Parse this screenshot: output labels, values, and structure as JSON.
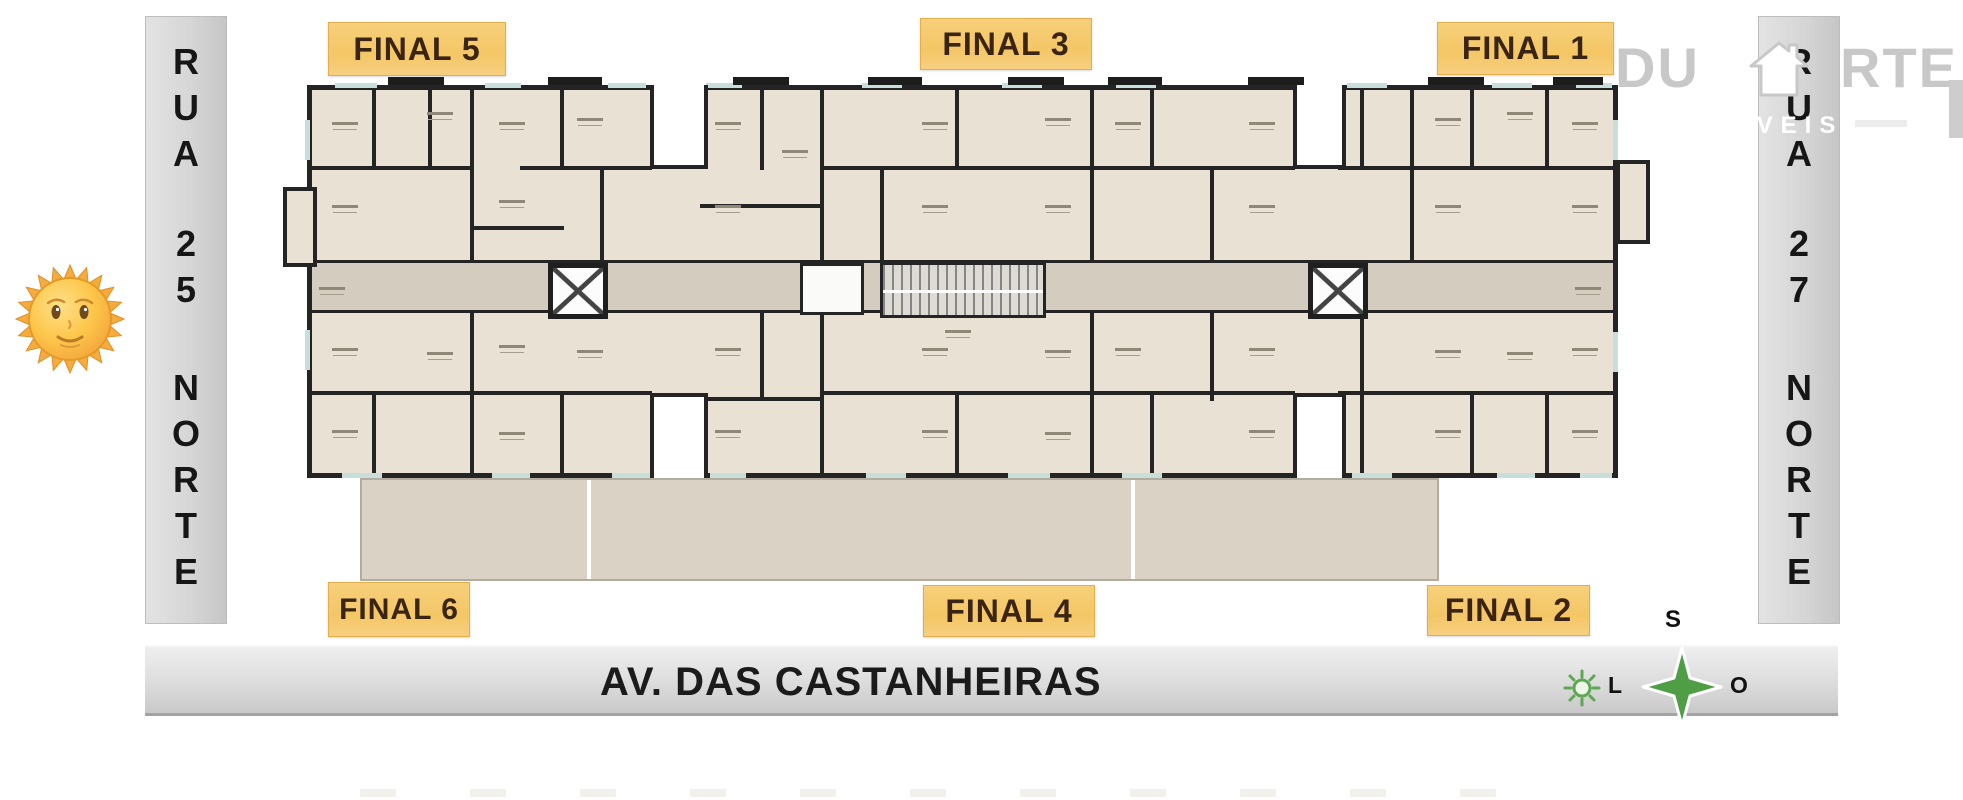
{
  "streets": {
    "rua_left": {
      "segments": [
        "RUA",
        "25",
        "NORTE"
      ]
    },
    "rua_right": {
      "segments": [
        "RUA",
        "27",
        "NORTE"
      ]
    },
    "avenue": {
      "name": "AV. DAS CASTANHEIRAS"
    }
  },
  "unit_labels": {
    "final_5": "FINAL 5",
    "final_3": "FINAL 3",
    "final_1": "FINAL 1",
    "final_6": "FINAL 6",
    "final_4": "FINAL 4",
    "final_2": "FINAL 2"
  },
  "compass": {
    "south": "S",
    "east": "L",
    "west": "O"
  },
  "watermark": {
    "name_prefix": "DU",
    "name_suffix": "RTE",
    "subtitle": "MÓVEIS"
  },
  "icons": {
    "sun_emoji": "sun-with-face",
    "compass_star": "four-point-star",
    "compass_sun": "sun-outline",
    "watermark_house": "house"
  },
  "colors": {
    "label_bg": "#f4c665",
    "label_text": "#3a2413",
    "street_bar": "#d6d6d6",
    "wall": "#242424",
    "floor": "#e9e1d4",
    "corridor": "#d4ccbe",
    "terrace": "#dad2c5",
    "compass_green": "#4f9d45",
    "watermark_gray": "#c8c8c8"
  }
}
